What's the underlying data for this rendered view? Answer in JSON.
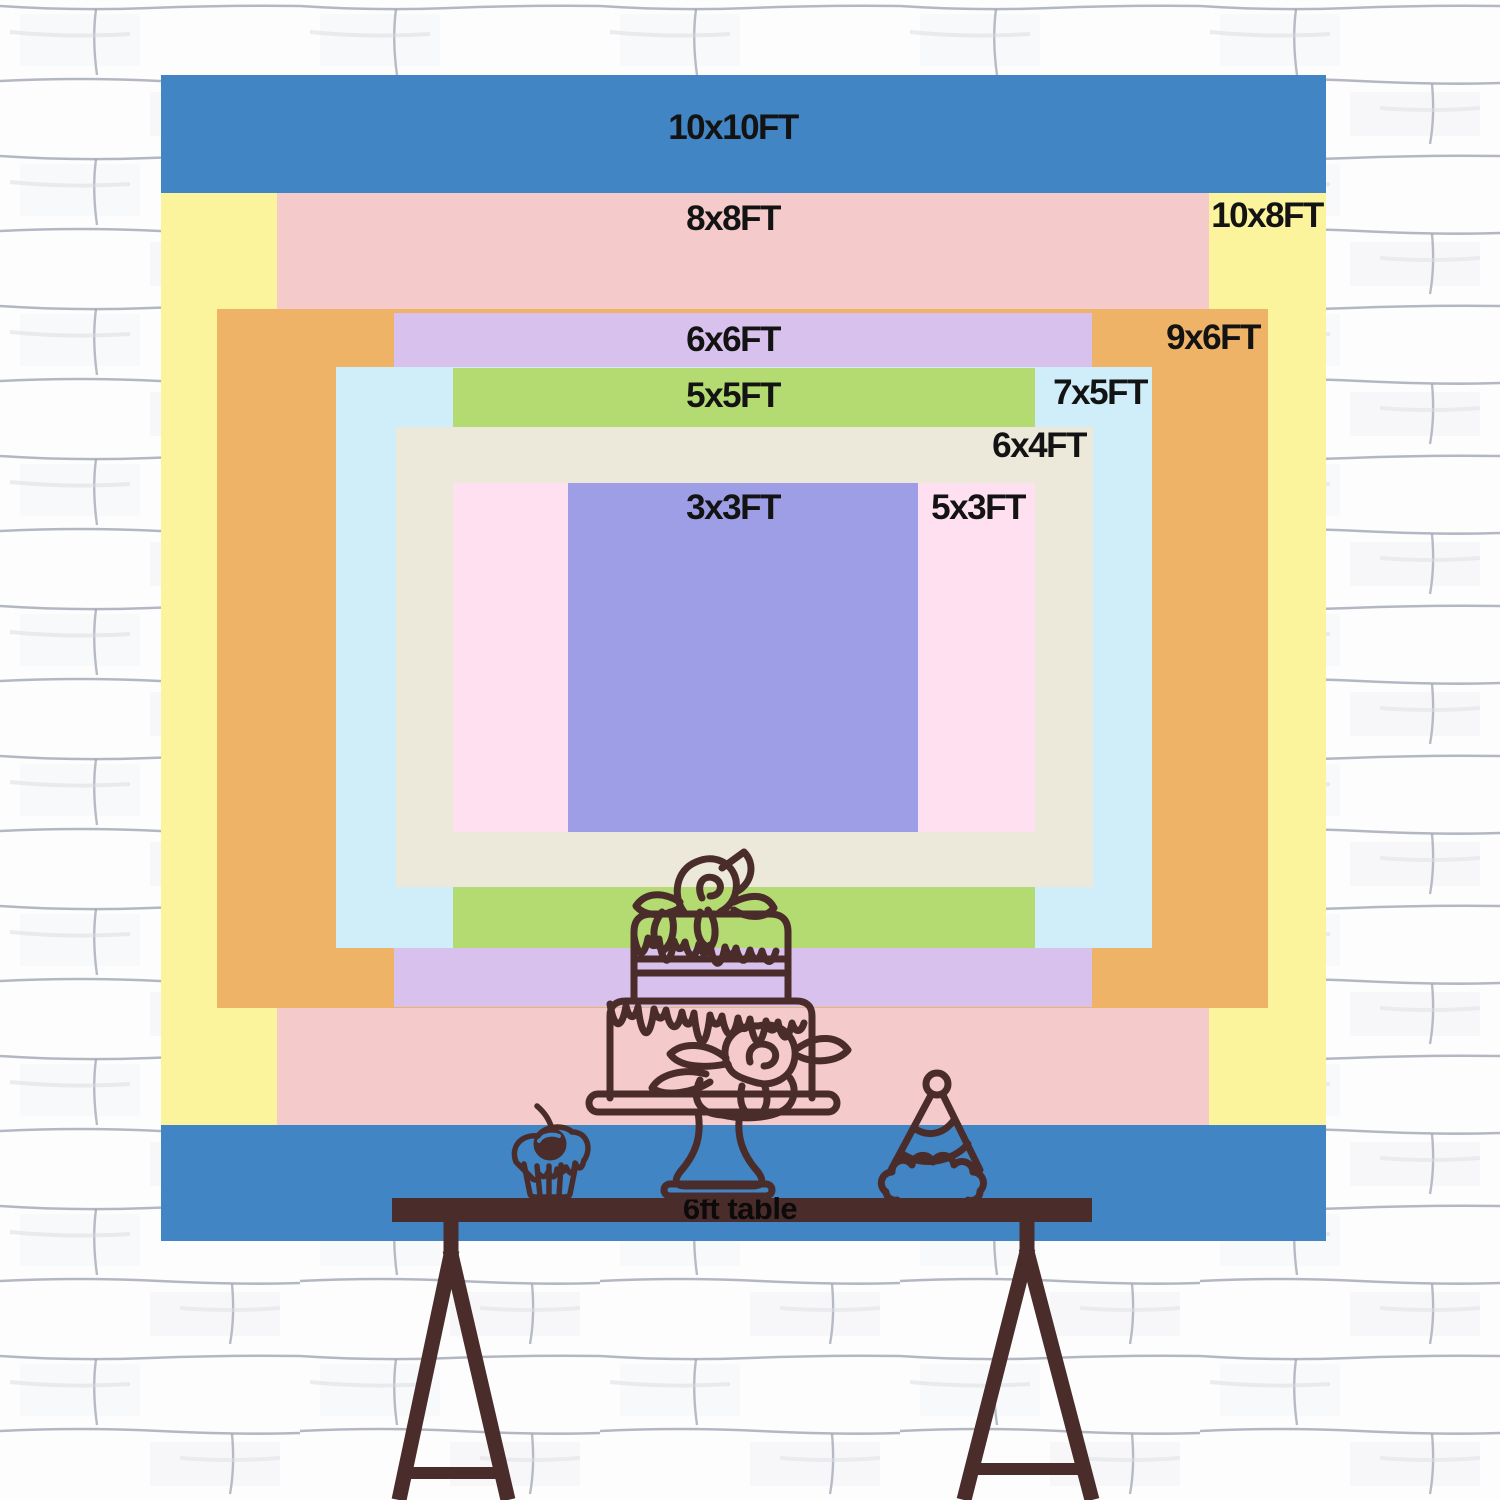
{
  "colors": {
    "ink": "#4a2d2b",
    "label_text": "#131313",
    "wall_bg": "#fdfdfd",
    "wall_mortar": "#9aa0ae",
    "backdrop_base": "#4285c4"
  },
  "backdrop": {
    "description": "nested backdrop size chart",
    "sizes": [
      {
        "label": "10x10FT",
        "w_ft": 10,
        "h_ft": 10,
        "color": "#4285c4",
        "x": 161,
        "y": 75,
        "w": 1165,
        "h": 1166,
        "label_x": 733,
        "label_y": 128
      },
      {
        "label": "10x8FT",
        "w_ft": 10,
        "h_ft": 8,
        "color": "#fbf49c",
        "x": 161,
        "y": 193,
        "w": 1165,
        "h": 932,
        "label_x": 1267,
        "label_y": 216
      },
      {
        "label": "8x8FT",
        "w_ft": 8,
        "h_ft": 8,
        "color": "#f4caca",
        "x": 277,
        "y": 193,
        "w": 932,
        "h": 932,
        "label_x": 733,
        "label_y": 219
      },
      {
        "label": "9x6FT",
        "w_ft": 9,
        "h_ft": 6,
        "color": "#eeb367",
        "x": 217,
        "y": 309,
        "w": 1051,
        "h": 699,
        "label_x": 1213,
        "label_y": 338
      },
      {
        "label": "6x6FT",
        "w_ft": 6,
        "h_ft": 6,
        "color": "#d9c1ee",
        "x": 394,
        "y": 313,
        "w": 698,
        "h": 694,
        "label_x": 733,
        "label_y": 340
      },
      {
        "label": "7x5FT",
        "w_ft": 7,
        "h_ft": 5,
        "color": "#cfeefa",
        "x": 336,
        "y": 367,
        "w": 816,
        "h": 581,
        "label_x": 1100,
        "label_y": 393
      },
      {
        "label": "5x5FT",
        "w_ft": 5,
        "h_ft": 5,
        "color": "#b4da72",
        "x": 453,
        "y": 368,
        "w": 582,
        "h": 580,
        "label_x": 733,
        "label_y": 396
      },
      {
        "label": "6x4FT",
        "w_ft": 6,
        "h_ft": 4,
        "color": "#ece9da",
        "x": 396,
        "y": 427,
        "w": 697,
        "h": 460,
        "label_x": 1039,
        "label_y": 446
      },
      {
        "label": "5x3FT",
        "w_ft": 5,
        "h_ft": 3,
        "color": "#ffe0f1",
        "x": 453,
        "y": 483,
        "w": 582,
        "h": 349,
        "label_x": 978,
        "label_y": 508
      },
      {
        "label": "3x3FT",
        "w_ft": 3,
        "h_ft": 3,
        "color": "#9e9ee6",
        "x": 568,
        "y": 483,
        "w": 350,
        "h": 349,
        "label_x": 733,
        "label_y": 508
      }
    ]
  },
  "table": {
    "label": "6ft table",
    "length_ft": 6
  },
  "illustrations": [
    {
      "name": "tiered-cake"
    },
    {
      "name": "cupcake"
    },
    {
      "name": "party-hat"
    }
  ]
}
